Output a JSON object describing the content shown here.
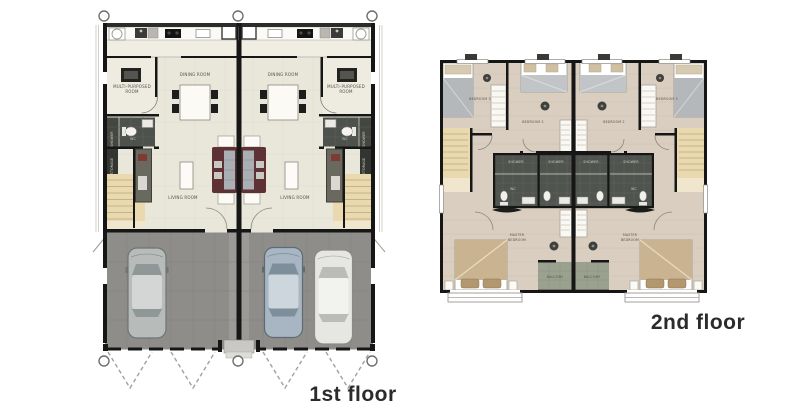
{
  "captions": {
    "first_floor": "1st floor",
    "second_floor": "2nd floor"
  },
  "first_floor": {
    "labels": {
      "dining_room": "DINING ROOM",
      "living_room": "LIVING ROOM",
      "multi_purpose_line1": "MULTI-PURPOSED",
      "multi_purpose_line2": "ROOM",
      "wc": "WC",
      "shower": "SHOWER",
      "storage": "STORAGE"
    }
  },
  "second_floor": {
    "labels": {
      "bedroom_2": "BEDROOM 2",
      "bedroom_3": "BEDROOM 3",
      "master_line1": "MASTER",
      "master_line2": "BEDROOM",
      "shower": "SHOWER",
      "wc": "WC",
      "balcony": "BALCONY"
    }
  },
  "colors": {
    "wall": "#161616",
    "interior_floor": "#e9e6da",
    "kitchen_floor": "#f0ede2",
    "garage_floor": "#8e8d89",
    "wood_floor": "#d9cec0",
    "bathroom_tile": "#4e524c",
    "balcony_floor": "#9aa18f",
    "stair": "#ead9ae",
    "sofa": "#5e3134",
    "master_blanket": "#cab390",
    "caption_text": "#2b2b2b",
    "label_text": "#55504a"
  }
}
